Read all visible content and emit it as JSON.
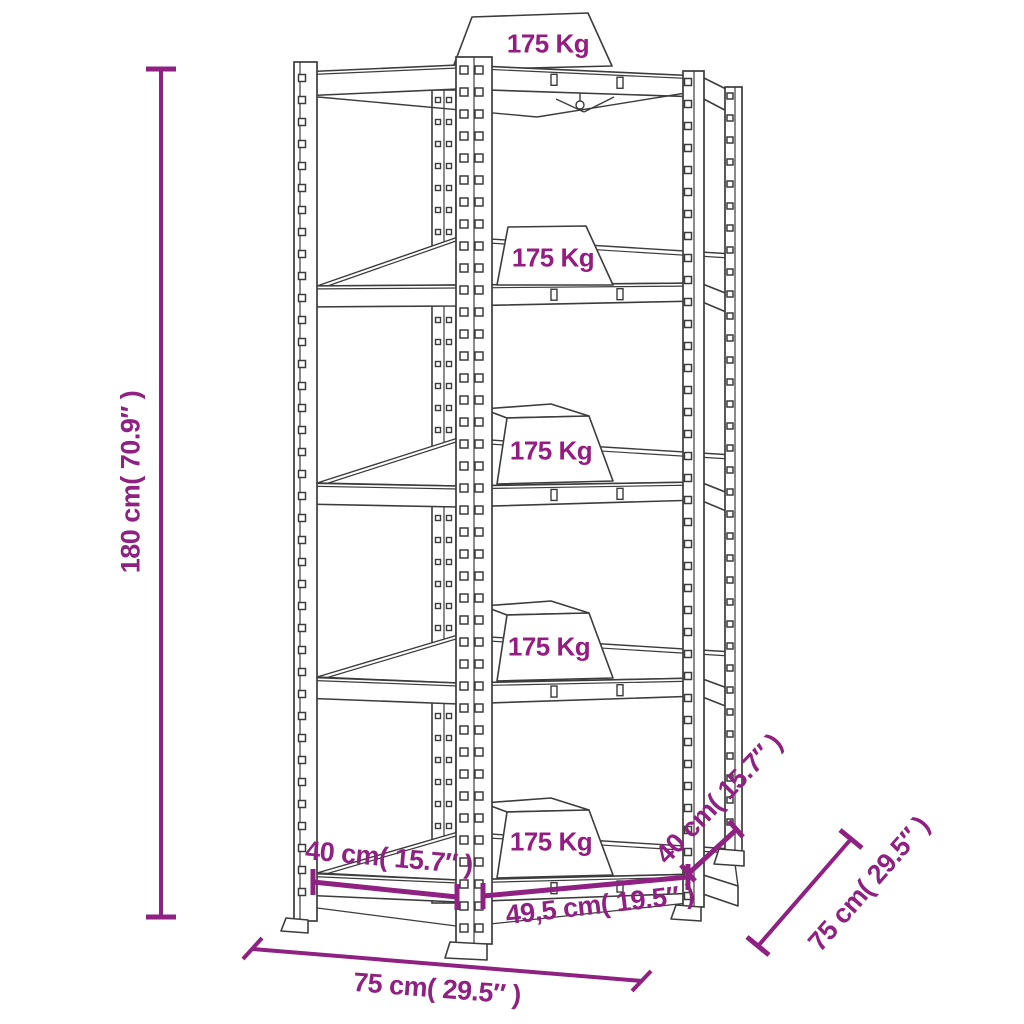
{
  "colors": {
    "dimension": "#8E2181",
    "weight_text": "#951C80",
    "line": "#3C3C3C",
    "background": "#ffffff"
  },
  "shelves": [
    {
      "capacity_label": "175 Kg"
    },
    {
      "capacity_label": "175 Kg"
    },
    {
      "capacity_label": "175 Kg"
    },
    {
      "capacity_label": "175 Kg"
    },
    {
      "capacity_label": "175 Kg"
    }
  ],
  "dimensions": {
    "height": "180 cm( 70.9″ )",
    "front_width": "75 cm( 29.5″ )",
    "side_depth": "75 cm( 29.5″ )",
    "front_left_section": "40 cm( 15.7″ )",
    "front_diagonal_section": "49,5 cm( 19.5″ )",
    "front_right_section": "40 cm( 15.7″ )"
  }
}
